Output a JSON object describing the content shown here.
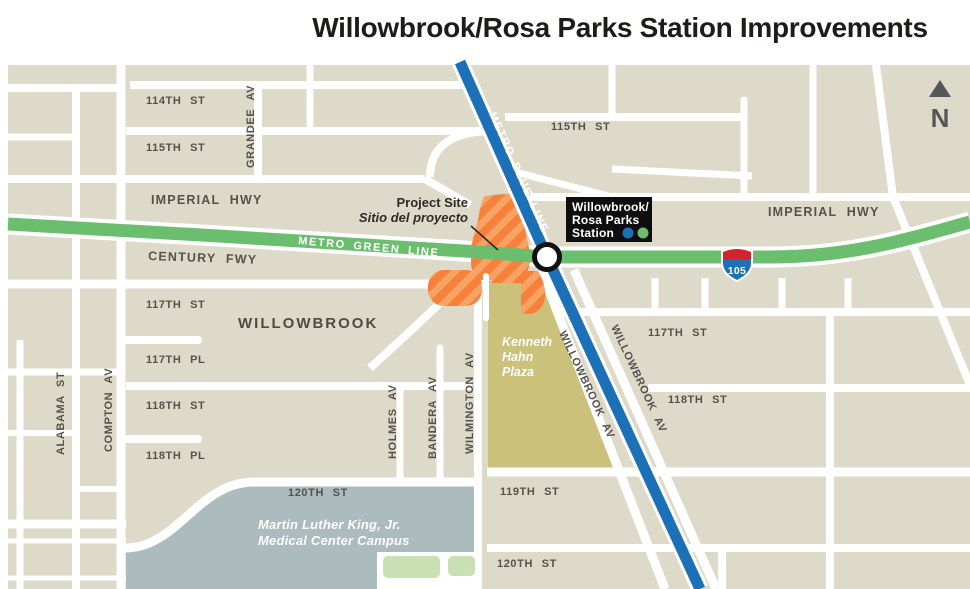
{
  "title": "Willowbrook/Rosa Parks Station Improvements",
  "compass": {
    "label": "N"
  },
  "transit": {
    "green_line_label": "METRO GREEN LINE",
    "blue_line_label": "METRO BLUE LINE",
    "interstate_shield": "105",
    "station": {
      "line1": "Willowbrook/",
      "line2": "Rosa Parks",
      "line3": "Station"
    }
  },
  "project_site": {
    "label_en": "Project Site",
    "label_es": "Sitio del proyecto"
  },
  "areas": {
    "district": "WILLOWBROOK",
    "plaza": {
      "line1": "Kenneth",
      "line2": "Hahn",
      "line3": "Plaza"
    },
    "campus": {
      "line1": "Martin Luther King, Jr.",
      "line2": "Medical Center Campus"
    }
  },
  "streets": {
    "st_114": "114TH ST",
    "st_115_w": "115TH ST",
    "grandee_av": "GRANDEE AV",
    "imperial_hwy_w": "IMPERIAL HWY",
    "century_fwy": "CENTURY FWY",
    "st_117_w": "117TH ST",
    "st_117_pl": "117TH PL",
    "st_118_w": "118TH ST",
    "st_118_pl": "118TH PL",
    "alabama_st": "ALABAMA ST",
    "compton_av": "COMPTON AV",
    "holmes_av": "HOLMES AV",
    "bandera_av": "BANDERA AV",
    "wilmington_av": "WILMINGTON AV",
    "st_120_w": "120TH ST",
    "st_115_e": "115TH ST",
    "imperial_hwy_e": "IMPERIAL HWY",
    "st_117_e": "117TH ST",
    "st_118_e": "118TH ST",
    "st_119": "119TH ST",
    "st_120_e": "120TH ST",
    "willowbrook_av_w": "WILLOWBROOK AV",
    "willowbrook_av_e": "WILLOWBROOK AV"
  },
  "colors": {
    "block": "#DEDACA",
    "street": "#FFFFFF",
    "metro_green": "#6CBE6F",
    "metro_blue": "#1C70B7",
    "site_orange": "#F5813A",
    "site_orange_stripe": "#F8A263",
    "plaza_olive": "#CCC17B",
    "campus_gray_blue": "#ACBBBD",
    "park_green": "#C9DFB4",
    "street_label": "#56524B",
    "shield_red": "#D2232A",
    "station_box_black": "#0E0E0E",
    "title_black": "#1E1B19",
    "compass_gray": "#55565A"
  }
}
